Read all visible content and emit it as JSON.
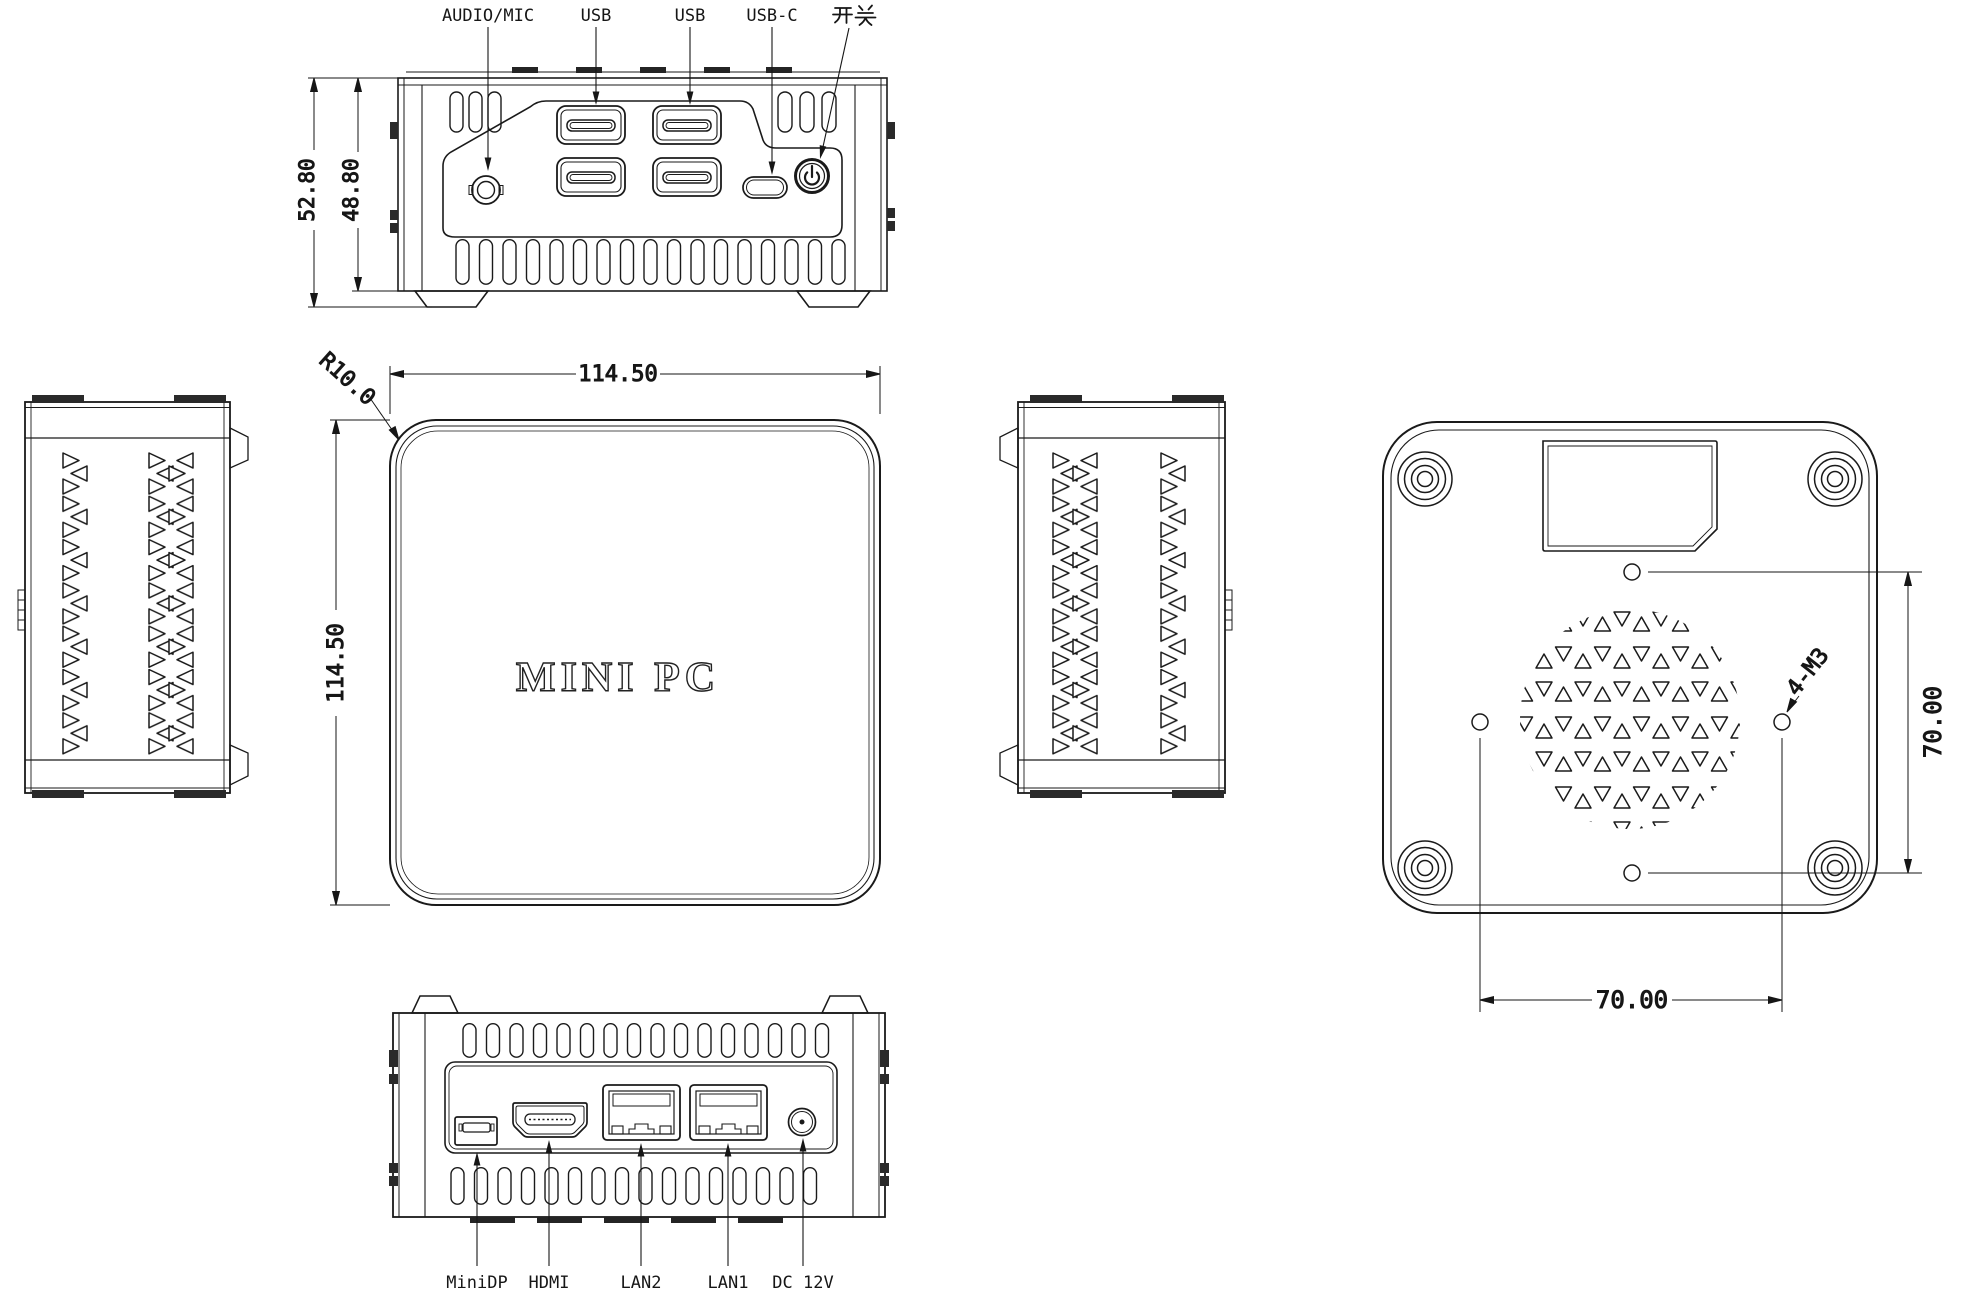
{
  "views": {
    "front": {
      "labels": {
        "audio": "AUDIO/MIC",
        "usb_a": "USB",
        "usb_b": "USB",
        "usb_c": "USB-C",
        "power_switch": "开关"
      },
      "dims": {
        "overall_height": "52.80",
        "body_height": "48.80"
      }
    },
    "top": {
      "engraving": "MINI PC",
      "dims": {
        "width": "114.50",
        "depth": "114.50",
        "corner_radius": "R10.0"
      }
    },
    "bottom": {
      "screw_note": "4-M3",
      "dims": {
        "hole_spacing_vertical": "70.00",
        "hole_spacing_horizontal": "70.00"
      }
    },
    "rear": {
      "labels": {
        "minidp": "MiniDP",
        "hdmi": "HDMI",
        "lan2": "LAN2",
        "lan1": "LAN1",
        "dc": "DC 12V"
      }
    }
  },
  "colors": {
    "line": "#1a1a1a",
    "background": "#ffffff"
  }
}
